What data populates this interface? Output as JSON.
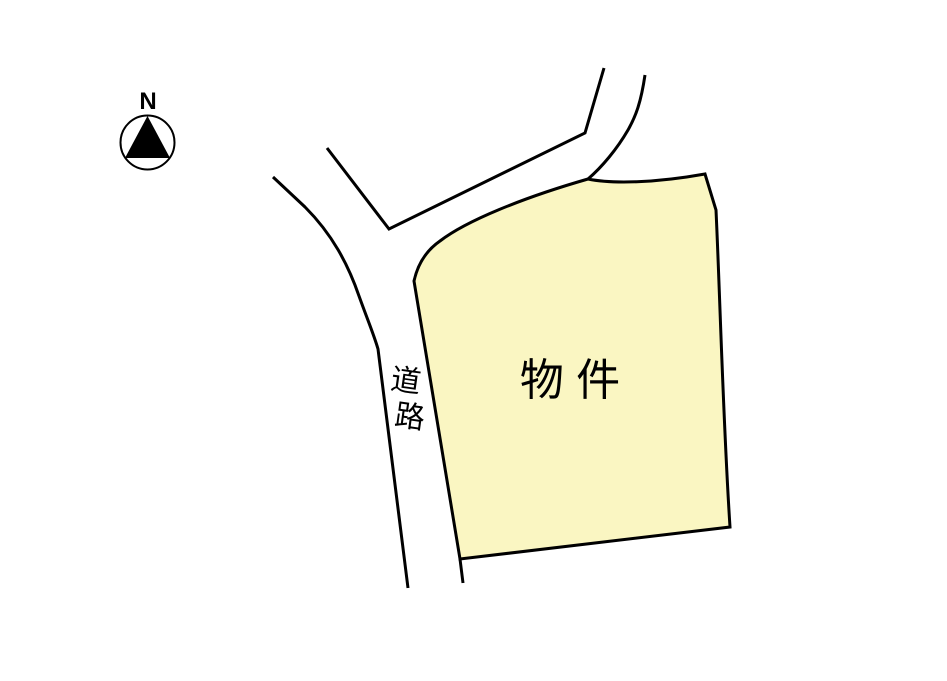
{
  "map": {
    "title": "site-location-sketch",
    "compass": {
      "label": "N"
    },
    "parcel": {
      "label": "物 件",
      "fill": "#FAF6C2"
    },
    "road": {
      "label": "道路",
      "label_chars": [
        "道",
        "路"
      ]
    }
  },
  "colors": {
    "background": "#FFFFFF",
    "line": "#000000",
    "parcel_fill": "#FAF6C2",
    "compass_needle": "#000000"
  }
}
